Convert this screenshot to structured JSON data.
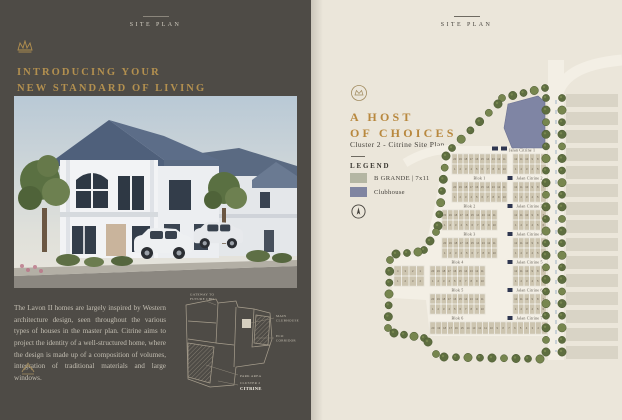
{
  "left_page": {
    "header": "SITE PLAN",
    "title_line1": "INTRODUCING YOUR",
    "title_line2": "NEW STANDARD OF LIVING",
    "body": "The Lavon II homes are largely inspired by Western architecture design, seen throughout the various types of houses in the master plan. Citrine aims to project the identity of a well-structured home, where the design is made up of a composition of volumes, integration of traditional materials and large windows.",
    "minimap": {
      "gateway_line1": "GATEWAY TO",
      "gateway_line2": "FUTURE CBD",
      "clubhouse_line1": "MAIN",
      "clubhouse_line2": "CLUBHOUSE",
      "eco_line1": "ECO",
      "eco_line2": "CORRIDOR",
      "park": "PARK AREA",
      "cluster_line1": "CLUSTER 2",
      "cluster_line2": "CITRINE"
    }
  },
  "right_page": {
    "header": "SITE PLAN",
    "title_line1": "A HOST",
    "title_line2": "OF CHOICES",
    "subtitle": "Cluster 2 - Citrine Site Plan",
    "legend": {
      "heading": "LEGEND",
      "items": [
        {
          "label": "B GRANDE | 7x11",
          "color": "#b4b6a3"
        },
        {
          "label": "Clubhouse",
          "color": "#8085a1"
        }
      ]
    }
  },
  "siteplan": {
    "entry_street": "Jalan Citrine 1",
    "rows": [
      {
        "blok": "Blok 1",
        "street": "Jalan Citrine 2"
      },
      {
        "blok": "Blok 2",
        "street": "Jalan Citrine 3"
      },
      {
        "blok": "Blok 3",
        "street": "Jalan Citrine 4"
      },
      {
        "blok": "Blok 4",
        "street": "Jalan Citrine 5"
      },
      {
        "blok": "Blok 5",
        "street": "Jalan Citrine 6"
      },
      {
        "blok": "Blok 6",
        "street": "Jalan Citrine 7"
      }
    ],
    "left_top": [
      20,
      19,
      18,
      17,
      16,
      15,
      14,
      13,
      12,
      11
    ],
    "left_bottom": [
      1,
      2,
      3,
      4,
      5,
      6,
      7,
      8,
      9,
      10
    ],
    "right_top": [
      12,
      11,
      10,
      9,
      8,
      7
    ],
    "right_bottom": [
      1,
      2,
      3,
      4,
      5,
      6
    ],
    "mini_top": [
      4,
      3,
      2,
      1
    ],
    "mini_bottom": [
      1,
      2,
      3,
      4
    ],
    "bottom_row": [
      20,
      19,
      18,
      17,
      16,
      15,
      14,
      13,
      12,
      11,
      10,
      9,
      8,
      7,
      6,
      5,
      4,
      3,
      2,
      1
    ]
  },
  "colors": {
    "plot": "#cdc5b0",
    "plot_border": "#b2a88f",
    "clubhouse": "#7f85a4",
    "tree": "#5e6e40",
    "tree_rim": "#49572f",
    "tree_light": "#77864f",
    "road": "#f3efe5",
    "neighbor": "#d9d4c6",
    "marker": "#2e3650",
    "dash": "#a7b9c9",
    "lot_text": "#6e6455",
    "street_text": "#5b564d",
    "gold": "#b3904f"
  }
}
